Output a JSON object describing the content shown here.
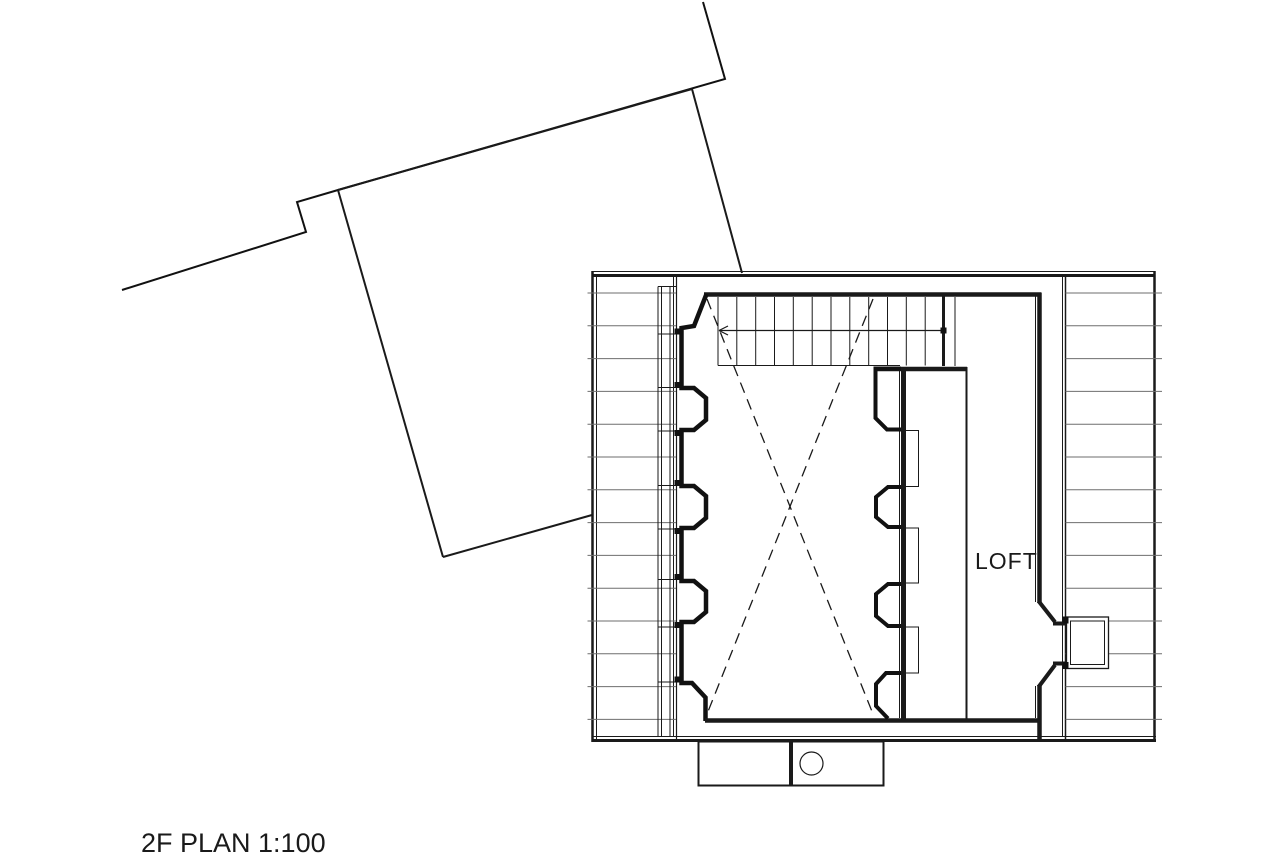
{
  "plan": {
    "labels": {
      "room": "LOFT",
      "caption": "2F PLAN 1:100"
    },
    "label_positions": {
      "room": {
        "left": 975,
        "top": 548
      },
      "caption": {
        "left": 141,
        "top": 828
      }
    },
    "colors": {
      "line": "#1a1a1a",
      "wall": "#111111",
      "hatch": "#6e6e6e",
      "background": "#ffffff"
    },
    "geometry": [
      {
        "name": "site-boundary",
        "t": "poly",
        "pts": [
          [
            703,
            2
          ],
          [
            725,
            79
          ],
          [
            338,
            190
          ],
          [
            297,
            202
          ],
          [
            306,
            232
          ],
          [
            122,
            290
          ]
        ],
        "w": 2
      },
      {
        "name": "lower-roof-top-edge",
        "t": "line",
        "x1": 338,
        "y1": 190,
        "x2": 692,
        "y2": 89,
        "w": 2
      },
      {
        "name": "lower-roof-left-edge",
        "t": "line",
        "x1": 338,
        "y1": 190,
        "x2": 443,
        "y2": 557,
        "w": 2
      },
      {
        "name": "lower-roof-right-edge",
        "t": "line",
        "x1": 692,
        "y1": 89,
        "x2": 742,
        "y2": 273,
        "w": 2
      },
      {
        "name": "lower-roof-bottom-edge",
        "t": "line",
        "x1": 443,
        "y1": 557,
        "x2": 592,
        "y2": 515,
        "w": 2
      },
      {
        "name": "building-top-edge-thin",
        "t": "line",
        "x1": 592,
        "y1": 271.5,
        "x2": 1155,
        "y2": 271.5,
        "w": 1
      },
      {
        "name": "building-top-edge",
        "t": "line",
        "x1": 592,
        "y1": 275.5,
        "x2": 1155,
        "y2": 275.5,
        "w": 3
      },
      {
        "name": "building-bottom-edge-thin",
        "t": "line",
        "x1": 592,
        "y1": 736.5,
        "x2": 1156,
        "y2": 736.5,
        "w": 1
      },
      {
        "name": "building-bottom-edge",
        "t": "line",
        "x1": 592,
        "y1": 740.5,
        "x2": 1156,
        "y2": 740.5,
        "w": 3
      },
      {
        "name": "left-eave-outer",
        "t": "line",
        "x1": 592.5,
        "y1": 271,
        "x2": 592.5,
        "y2": 742,
        "w": 2.5
      },
      {
        "name": "left-eave-outer2",
        "t": "line",
        "x1": 596.5,
        "y1": 275,
        "x2": 596.5,
        "y2": 740,
        "w": 1
      },
      {
        "name": "right-eave-outer",
        "t": "line",
        "x1": 1154.5,
        "y1": 271,
        "x2": 1154.5,
        "y2": 742,
        "w": 2.5
      },
      {
        "name": "left-eave-inner",
        "t": "line",
        "x1": 676.5,
        "y1": 275,
        "x2": 676.5,
        "y2": 740,
        "w": 1.2
      },
      {
        "name": "left-eave-inner2",
        "t": "line",
        "x1": 673.5,
        "y1": 277,
        "x2": 673.5,
        "y2": 737,
        "w": 1
      },
      {
        "name": "right-eave-inner",
        "t": "line",
        "x1": 1065.5,
        "y1": 275,
        "x2": 1065.5,
        "y2": 740,
        "w": 1.5
      },
      {
        "name": "right-eave-inner2",
        "t": "line",
        "x1": 1062.5,
        "y1": 277,
        "x2": 1062.5,
        "y2": 737,
        "w": 1
      },
      {
        "name": "left-roof-hatch",
        "t": "hatch",
        "y0": 293,
        "dy": 32.8,
        "n": 14,
        "x1": 587.5,
        "x2": 676,
        "w": 1
      },
      {
        "name": "right-roof-hatch",
        "t": "hatch",
        "y0": 293,
        "dy": 32.8,
        "n": 14,
        "x1": 1065.5,
        "x2": 1162,
        "w": 1
      },
      {
        "name": "left-window-col-1",
        "t": "line",
        "x1": 658,
        "y1": 286.5,
        "x2": 658,
        "y2": 737,
        "w": 1
      },
      {
        "name": "left-window-col-2",
        "t": "line",
        "x1": 661.5,
        "y1": 286.5,
        "x2": 661.5,
        "y2": 737,
        "w": 1
      },
      {
        "name": "left-window-col-3",
        "t": "line",
        "x1": 670,
        "y1": 286.5,
        "x2": 670,
        "y2": 737,
        "w": 1
      },
      {
        "name": "left-window-cap",
        "t": "line",
        "x1": 658,
        "y1": 286.5,
        "x2": 676.5,
        "y2": 286.5,
        "w": 1
      },
      {
        "name": "left-window-divider",
        "t": "line",
        "x1": 658,
        "y1": 334,
        "x2": 674.5,
        "y2": 334,
        "w": 1
      },
      {
        "name": "left-window-divider",
        "t": "line",
        "x1": 658,
        "y1": 387.5,
        "x2": 674.5,
        "y2": 387.5,
        "w": 1
      },
      {
        "name": "left-window-divider",
        "t": "line",
        "x1": 658,
        "y1": 431,
        "x2": 674.5,
        "y2": 431,
        "w": 1
      },
      {
        "name": "left-window-divider",
        "t": "line",
        "x1": 658,
        "y1": 485.5,
        "x2": 674.5,
        "y2": 485.5,
        "w": 1
      },
      {
        "name": "left-window-divider",
        "t": "line",
        "x1": 658,
        "y1": 529,
        "x2": 674.5,
        "y2": 529,
        "w": 1
      },
      {
        "name": "left-window-divider",
        "t": "line",
        "x1": 658,
        "y1": 579.5,
        "x2": 674.5,
        "y2": 579.5,
        "w": 1
      },
      {
        "name": "left-window-divider",
        "t": "line",
        "x1": 658,
        "y1": 627,
        "x2": 674.5,
        "y2": 627,
        "w": 1
      },
      {
        "name": "left-window-divider",
        "t": "line",
        "x1": 658,
        "y1": 682,
        "x2": 674.5,
        "y2": 682,
        "w": 1
      },
      {
        "name": "left-wall-post",
        "t": "fillrect",
        "x": 674.5,
        "y": 328.5,
        "wd": 7,
        "h": 6
      },
      {
        "name": "left-wall-post",
        "t": "fillrect",
        "x": 674.5,
        "y": 382,
        "wd": 7,
        "h": 6
      },
      {
        "name": "left-wall-post",
        "t": "fillrect",
        "x": 674.5,
        "y": 430,
        "wd": 7,
        "h": 6
      },
      {
        "name": "left-wall-post",
        "t": "fillrect",
        "x": 674.5,
        "y": 480,
        "wd": 7,
        "h": 6
      },
      {
        "name": "left-wall-post",
        "t": "fillrect",
        "x": 674.5,
        "y": 528,
        "wd": 7,
        "h": 6
      },
      {
        "name": "left-wall-post",
        "t": "fillrect",
        "x": 674.5,
        "y": 574,
        "wd": 7,
        "h": 6
      },
      {
        "name": "left-wall-post",
        "t": "fillrect",
        "x": 674.5,
        "y": 622,
        "wd": 7,
        "h": 6
      },
      {
        "name": "left-wall-post",
        "t": "fillrect",
        "x": 674.5,
        "y": 676.5,
        "wd": 7,
        "h": 6
      },
      {
        "name": "room-top-wall",
        "t": "line",
        "x1": 704,
        "y1": 294.5,
        "x2": 1041.5,
        "y2": 294.5,
        "w": 4.5
      },
      {
        "name": "left-wall-profile",
        "t": "poly",
        "w": 4.5,
        "pts": [
          [
            706.5,
            294
          ],
          [
            694,
            326
          ],
          [
            681.5,
            328
          ],
          [
            681.5,
            388
          ],
          [
            694,
            388
          ],
          [
            706,
            398
          ],
          [
            706,
            420
          ],
          [
            694,
            430
          ],
          [
            681.5,
            430
          ],
          [
            681.5,
            486
          ],
          [
            694,
            486
          ],
          [
            706,
            496
          ],
          [
            706,
            518
          ],
          [
            694,
            528
          ],
          [
            681.5,
            528
          ],
          [
            681.5,
            581
          ],
          [
            694,
            581
          ],
          [
            706,
            591
          ],
          [
            706,
            612
          ],
          [
            694,
            622
          ],
          [
            681.5,
            622
          ],
          [
            681.5,
            683
          ],
          [
            692,
            683
          ],
          [
            705.5,
            697.5
          ],
          [
            705.5,
            721
          ]
        ]
      },
      {
        "name": "room-bottom-wall",
        "t": "line",
        "x1": 705,
        "y1": 720.5,
        "x2": 1041.5,
        "y2": 720.5,
        "w": 4.5
      },
      {
        "name": "stair-end-wall",
        "t": "line",
        "x1": 943.5,
        "y1": 296,
        "x2": 943.5,
        "y2": 366,
        "w": 3
      },
      {
        "name": "stair-side-line",
        "t": "line",
        "x1": 955,
        "y1": 297,
        "x2": 955,
        "y2": 366,
        "w": 1
      },
      {
        "name": "stair-bottom-wall",
        "t": "line",
        "x1": 875,
        "y1": 369,
        "x2": 967,
        "y2": 369,
        "w": 4.5
      },
      {
        "name": "stair-tread",
        "t": "line",
        "x1": 718,
        "y1": 297,
        "x2": 718,
        "y2": 365.5,
        "w": 1
      },
      {
        "name": "stair-tread",
        "t": "line",
        "x1": 736.8,
        "y1": 297,
        "x2": 736.8,
        "y2": 365.5,
        "w": 1
      },
      {
        "name": "stair-tread",
        "t": "line",
        "x1": 755.7,
        "y1": 297,
        "x2": 755.7,
        "y2": 365.5,
        "w": 1
      },
      {
        "name": "stair-tread",
        "t": "line",
        "x1": 774.5,
        "y1": 297,
        "x2": 774.5,
        "y2": 365.5,
        "w": 1
      },
      {
        "name": "stair-tread",
        "t": "line",
        "x1": 793.3,
        "y1": 297,
        "x2": 793.3,
        "y2": 365.5,
        "w": 1
      },
      {
        "name": "stair-tread",
        "t": "line",
        "x1": 812.2,
        "y1": 297,
        "x2": 812.2,
        "y2": 365.5,
        "w": 1
      },
      {
        "name": "stair-tread",
        "t": "line",
        "x1": 831,
        "y1": 297,
        "x2": 831,
        "y2": 365.5,
        "w": 1
      },
      {
        "name": "stair-tread",
        "t": "line",
        "x1": 849.8,
        "y1": 297,
        "x2": 849.8,
        "y2": 365.5,
        "w": 1
      },
      {
        "name": "stair-tread",
        "t": "line",
        "x1": 868.7,
        "y1": 297,
        "x2": 868.7,
        "y2": 365.5,
        "w": 1
      },
      {
        "name": "stair-tread",
        "t": "line",
        "x1": 887.5,
        "y1": 297,
        "x2": 887.5,
        "y2": 365.5,
        "w": 1
      },
      {
        "name": "stair-tread",
        "t": "line",
        "x1": 906.3,
        "y1": 297,
        "x2": 906.3,
        "y2": 365.5,
        "w": 1
      },
      {
        "name": "stair-tread",
        "t": "line",
        "x1": 925.2,
        "y1": 297,
        "x2": 925.2,
        "y2": 365.5,
        "w": 1
      },
      {
        "name": "stair-bottom-line",
        "t": "line",
        "x1": 718,
        "y1": 365.5,
        "x2": 900,
        "y2": 365.5,
        "w": 1
      },
      {
        "name": "stair-center-line",
        "t": "line",
        "x1": 719,
        "y1": 330.5,
        "x2": 943,
        "y2": 330.5,
        "w": 1.2
      },
      {
        "name": "stair-arrow-stroke",
        "t": "line",
        "x1": 719,
        "y1": 330.5,
        "x2": 728,
        "y2": 326,
        "w": 1.2
      },
      {
        "name": "stair-arrow-stroke",
        "t": "line",
        "x1": 719,
        "y1": 330.5,
        "x2": 728,
        "y2": 335,
        "w": 1.2
      },
      {
        "name": "stair-start-dot",
        "t": "fillrect",
        "x": 940.5,
        "y": 327.5,
        "wd": 6,
        "h": 6
      },
      {
        "name": "void-dashed-x1",
        "t": "line",
        "x1": 707,
        "y1": 299,
        "x2": 873,
        "y2": 714,
        "w": 1.3,
        "dash": "11,7"
      },
      {
        "name": "void-dashed-x2",
        "t": "line",
        "x1": 873,
        "y1": 299,
        "x2": 707,
        "y2": 714,
        "w": 1.3,
        "dash": "11,7"
      },
      {
        "name": "mid-wall",
        "t": "line",
        "x1": 903.5,
        "y1": 367,
        "x2": 903.5,
        "y2": 722,
        "w": 5
      },
      {
        "name": "mid-wall-thin",
        "t": "line",
        "x1": 899.5,
        "y1": 368,
        "x2": 899.5,
        "y2": 718,
        "w": 1
      },
      {
        "name": "mid-wall-top-block",
        "t": "poly",
        "w": 4,
        "pts": [
          [
            901,
            368.5
          ],
          [
            875.5,
            368.5
          ],
          [
            875.5,
            418
          ],
          [
            887,
            429.5
          ],
          [
            901,
            429.5
          ]
        ]
      },
      {
        "name": "mid-wall-bump",
        "t": "poly",
        "w": 4,
        "pts": [
          [
            901,
            487
          ],
          [
            888,
            487
          ],
          [
            876,
            497
          ],
          [
            876,
            517
          ],
          [
            888,
            527
          ],
          [
            901,
            527
          ]
        ]
      },
      {
        "name": "mid-wall-bump",
        "t": "poly",
        "w": 4,
        "pts": [
          [
            901,
            584
          ],
          [
            888,
            584
          ],
          [
            876,
            594
          ],
          [
            876,
            616
          ],
          [
            888,
            626
          ],
          [
            901,
            626
          ]
        ]
      },
      {
        "name": "mid-wall-foot",
        "t": "poly",
        "w": 4,
        "pts": [
          [
            901,
            673
          ],
          [
            886,
            673
          ],
          [
            876,
            684
          ],
          [
            876,
            706
          ],
          [
            888,
            718.5
          ]
        ]
      },
      {
        "name": "loft-shelf-rect",
        "t": "rect",
        "x": 905.5,
        "y": 430.5,
        "wd": 13,
        "h": 56,
        "w": 1
      },
      {
        "name": "loft-shelf-rect",
        "t": "rect",
        "x": 905.5,
        "y": 528,
        "wd": 13,
        "h": 55,
        "w": 1
      },
      {
        "name": "loft-shelf-rect",
        "t": "rect",
        "x": 905.5,
        "y": 627,
        "wd": 13,
        "h": 46,
        "w": 1
      },
      {
        "name": "loft-left-partition",
        "t": "line",
        "x1": 966.5,
        "y1": 367,
        "x2": 966.5,
        "y2": 720,
        "w": 2
      },
      {
        "name": "loft-right-wall-upper",
        "t": "line",
        "x1": 1039.5,
        "y1": 293,
        "x2": 1039.5,
        "y2": 603,
        "w": 4.5
      },
      {
        "name": "loft-door-chamfer-upper",
        "t": "line",
        "x1": 1038.5,
        "y1": 601,
        "x2": 1055,
        "y2": 622,
        "w": 4
      },
      {
        "name": "loft-door-sill-upper",
        "t": "line",
        "x1": 1053,
        "y1": 623.5,
        "x2": 1067,
        "y2": 623.5,
        "w": 4
      },
      {
        "name": "loft-door-sill-lower",
        "t": "line",
        "x1": 1053,
        "y1": 663.5,
        "x2": 1067,
        "y2": 663.5,
        "w": 4
      },
      {
        "name": "loft-door-chamfer-lower",
        "t": "line",
        "x1": 1055,
        "y1": 665,
        "x2": 1038.5,
        "y2": 687,
        "w": 4
      },
      {
        "name": "loft-right-wall-lower",
        "t": "line",
        "x1": 1039.5,
        "y1": 685,
        "x2": 1039.5,
        "y2": 741,
        "w": 4.5
      },
      {
        "name": "loft-wall-face-line",
        "t": "line",
        "x1": 1035.5,
        "y1": 296,
        "x2": 1035.5,
        "y2": 602,
        "w": 1
      },
      {
        "name": "loft-wall-face-line",
        "t": "line",
        "x1": 1035.5,
        "y1": 686,
        "x2": 1035.5,
        "y2": 718,
        "w": 1
      },
      {
        "name": "dormer-box-outer",
        "t": "rect",
        "x": 1066.5,
        "y": 617,
        "wd": 42,
        "h": 51.5,
        "w": 1.3,
        "fill": "#ffffff"
      },
      {
        "name": "dormer-box-inner",
        "t": "rect",
        "x": 1070.5,
        "y": 621,
        "wd": 34,
        "h": 43.5,
        "w": 1
      },
      {
        "name": "dormer-post",
        "t": "fillrect",
        "x": 1062.5,
        "y": 616.5,
        "wd": 6,
        "h": 7
      },
      {
        "name": "dormer-post",
        "t": "fillrect",
        "x": 1062.5,
        "y": 662,
        "wd": 6,
        "h": 7
      },
      {
        "name": "porch-box-left",
        "t": "rect",
        "x": 698.5,
        "y": 741.5,
        "wd": 91.5,
        "h": 44,
        "w": 2
      },
      {
        "name": "porch-box-right",
        "t": "rect",
        "x": 792,
        "y": 741.5,
        "wd": 91.5,
        "h": 44,
        "w": 2
      },
      {
        "name": "porch-circle",
        "t": "circle",
        "cx": 811.5,
        "cy": 763.5,
        "r": 11.5,
        "w": 1.2
      }
    ]
  }
}
